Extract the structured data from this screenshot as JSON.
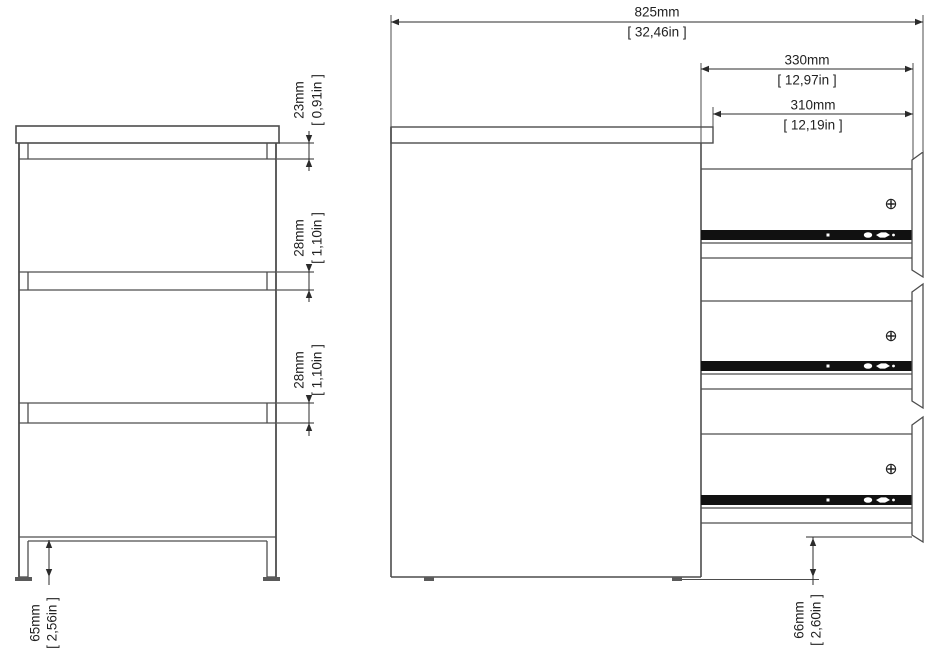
{
  "drawing": {
    "type": "furniture-dimension-drawing",
    "views": [
      "front-view-3-drawer-chest",
      "side-view-drawers-open"
    ],
    "line_color": "#4d4d4d",
    "dimension_color": "#2b2b2b",
    "rail_color": "#111111"
  },
  "front_view": {
    "dim_top_gap": {
      "mm": "23mm",
      "in": "[ 0,91in ]"
    },
    "dim_gap1": {
      "mm": "28mm",
      "in": "[ 1,10in ]"
    },
    "dim_gap2": {
      "mm": "28mm",
      "in": "[ 1,10in ]"
    },
    "dim_plinth": {
      "mm": "65mm",
      "in": "[ 2,56in ]"
    }
  },
  "side_view": {
    "dim_total_depth": {
      "mm": "825mm",
      "in": "[ 32,46in ]"
    },
    "dim_drawer_depth": {
      "mm": "330mm",
      "in": "[ 12,97in ]"
    },
    "dim_inner_depth": {
      "mm": "310mm",
      "in": "[ 12,19in ]"
    },
    "dim_floor_clearance": {
      "mm": "66mm",
      "in": "[ 2,60in ]"
    }
  }
}
